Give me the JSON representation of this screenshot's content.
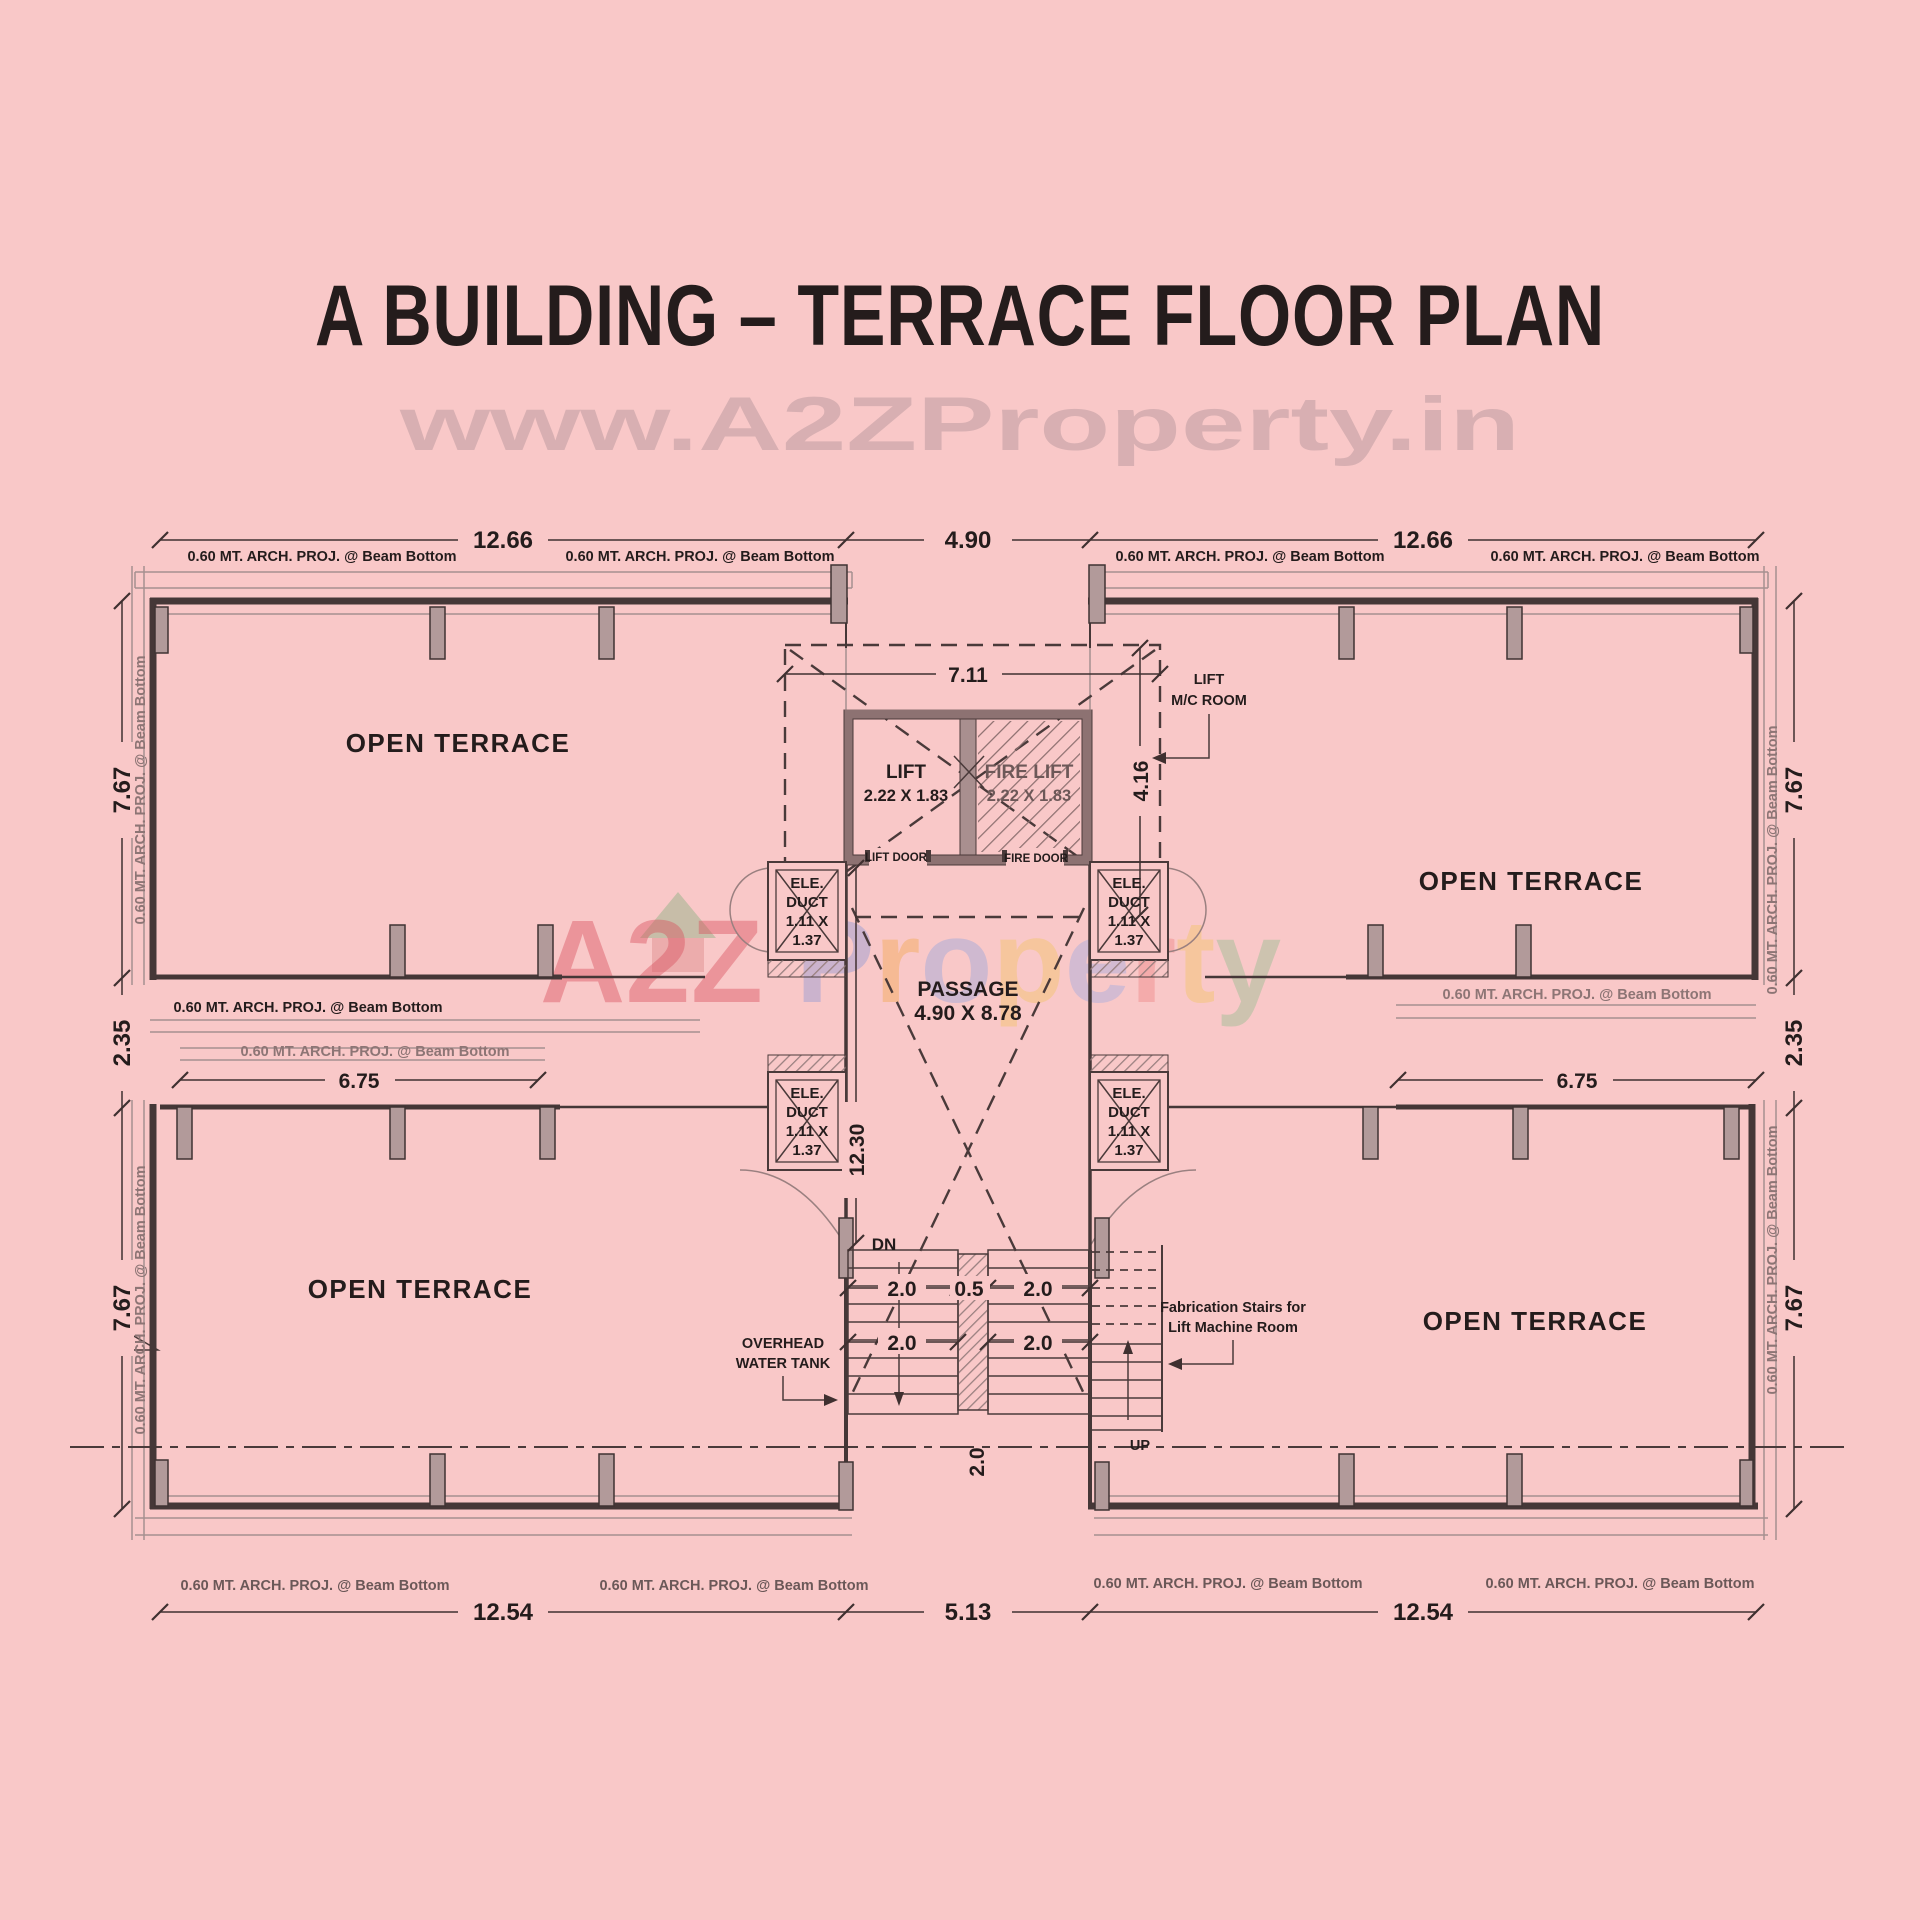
{
  "title": "A BUILDING – TERRACE FLOOR PLAN",
  "watermark": {
    "top": "www.A2ZProperty.in",
    "brand": [
      "A",
      "2",
      "Z",
      " ",
      "P",
      "r",
      "o",
      "p",
      "e",
      "r",
      "t",
      "y"
    ]
  },
  "rooms": {
    "open_terrace": "OPEN TERRACE",
    "passage_line1": "PASSAGE",
    "passage_line2": "4.90 X 8.78",
    "lift_line1": "LIFT",
    "lift_line2": "2.22 X 1.83",
    "fire_lift_line1": "FIRE LIFT",
    "fire_lift_line2": "2.22 X 1.83",
    "lift_door": "LIFT DOOR",
    "fire_door": "FIRE DOOR",
    "lift_mc_line1": "LIFT",
    "lift_mc_line2": "M/C ROOM"
  },
  "annotations": {
    "arch_proj": "0.60 MT. ARCH. PROJ. @ Beam Bottom",
    "ele_duct": [
      "ELE.",
      "DUCT",
      "1.11 X",
      "1.37"
    ],
    "overhead_line1": "OVERHEAD",
    "overhead_line2": "WATER TANK",
    "fab_line1": "Fabrication Stairs for",
    "fab_line2": "Lift Machine Room",
    "dn": "DN",
    "up": "UP"
  },
  "dimensions": {
    "top_left": "12.66",
    "top_center": "4.90",
    "top_right": "12.66",
    "bottom_left": "12.54",
    "bottom_center": "5.13",
    "bottom_right": "12.54",
    "left_upper": "7.67",
    "left_mid": "2.35",
    "left_lower": "7.67",
    "right_upper": "7.67",
    "right_mid": "2.35",
    "right_lower": "7.67",
    "mid_left": "6.75",
    "mid_right": "6.75",
    "lift_width": "7.11",
    "lift_depth": "4.16",
    "passage_height": "12.30",
    "stair_r1_l": "2.0",
    "stair_r1_m": "0.5",
    "stair_r1_r": "2.0",
    "stair_r2_l": "2.0",
    "stair_r2_r": "2.0",
    "stair_bottom": "2.0"
  },
  "colors": {
    "background": "#f9c8c8",
    "wall": "#453737",
    "column": "#b29a9a",
    "text": "#241c1c",
    "watermark_gray": "#a3898f",
    "brand_red": "#d94f5c"
  }
}
